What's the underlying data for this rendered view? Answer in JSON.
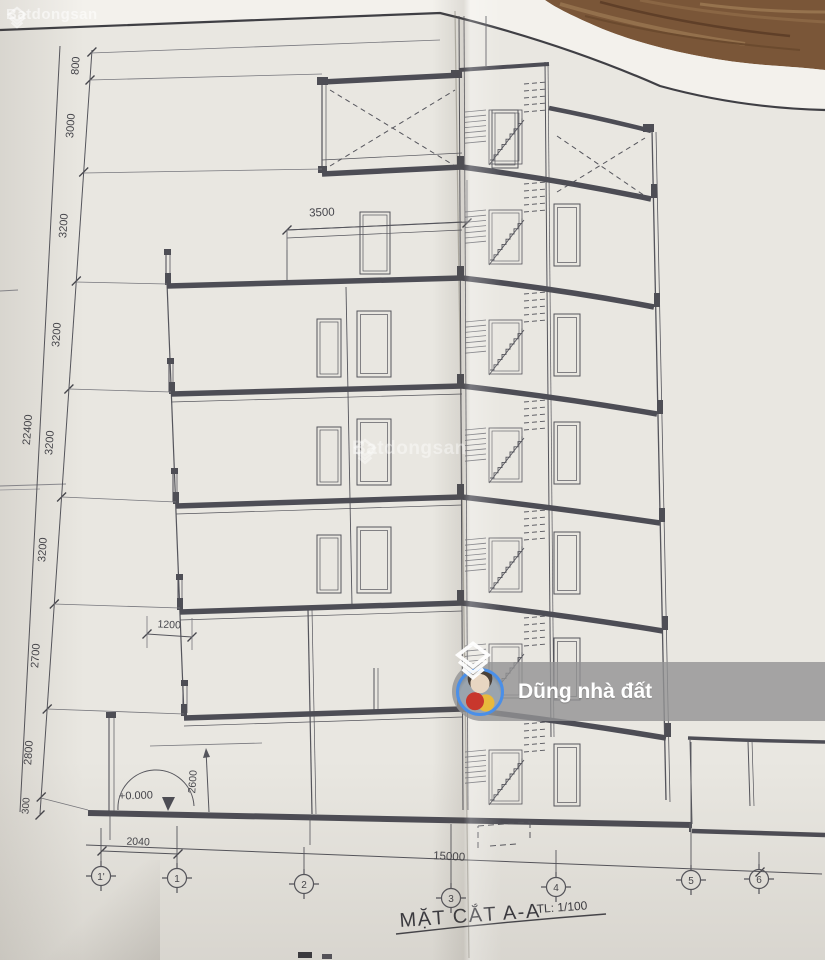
{
  "brand": {
    "name": "Batdongsan"
  },
  "overlay": {
    "agent_name": "Dũng nhà đất"
  },
  "drawing": {
    "title": "MẶT CẮT A-A",
    "scale": "TL: 1/100",
    "level_zero": "+0.000",
    "dims": {
      "left_chain": [
        "800",
        "3000",
        "3200",
        "3200",
        "3200",
        "3200",
        "2700",
        "2800",
        "300"
      ],
      "overall_height": "22400",
      "top_setback": "3500",
      "overhang": "1200",
      "ground_clear": "2600",
      "bottom_left_bay": "2040",
      "bottom_total": "15000"
    },
    "grid_labels": [
      "1'",
      "1",
      "2",
      "3",
      "4",
      "5",
      "6"
    ]
  }
}
